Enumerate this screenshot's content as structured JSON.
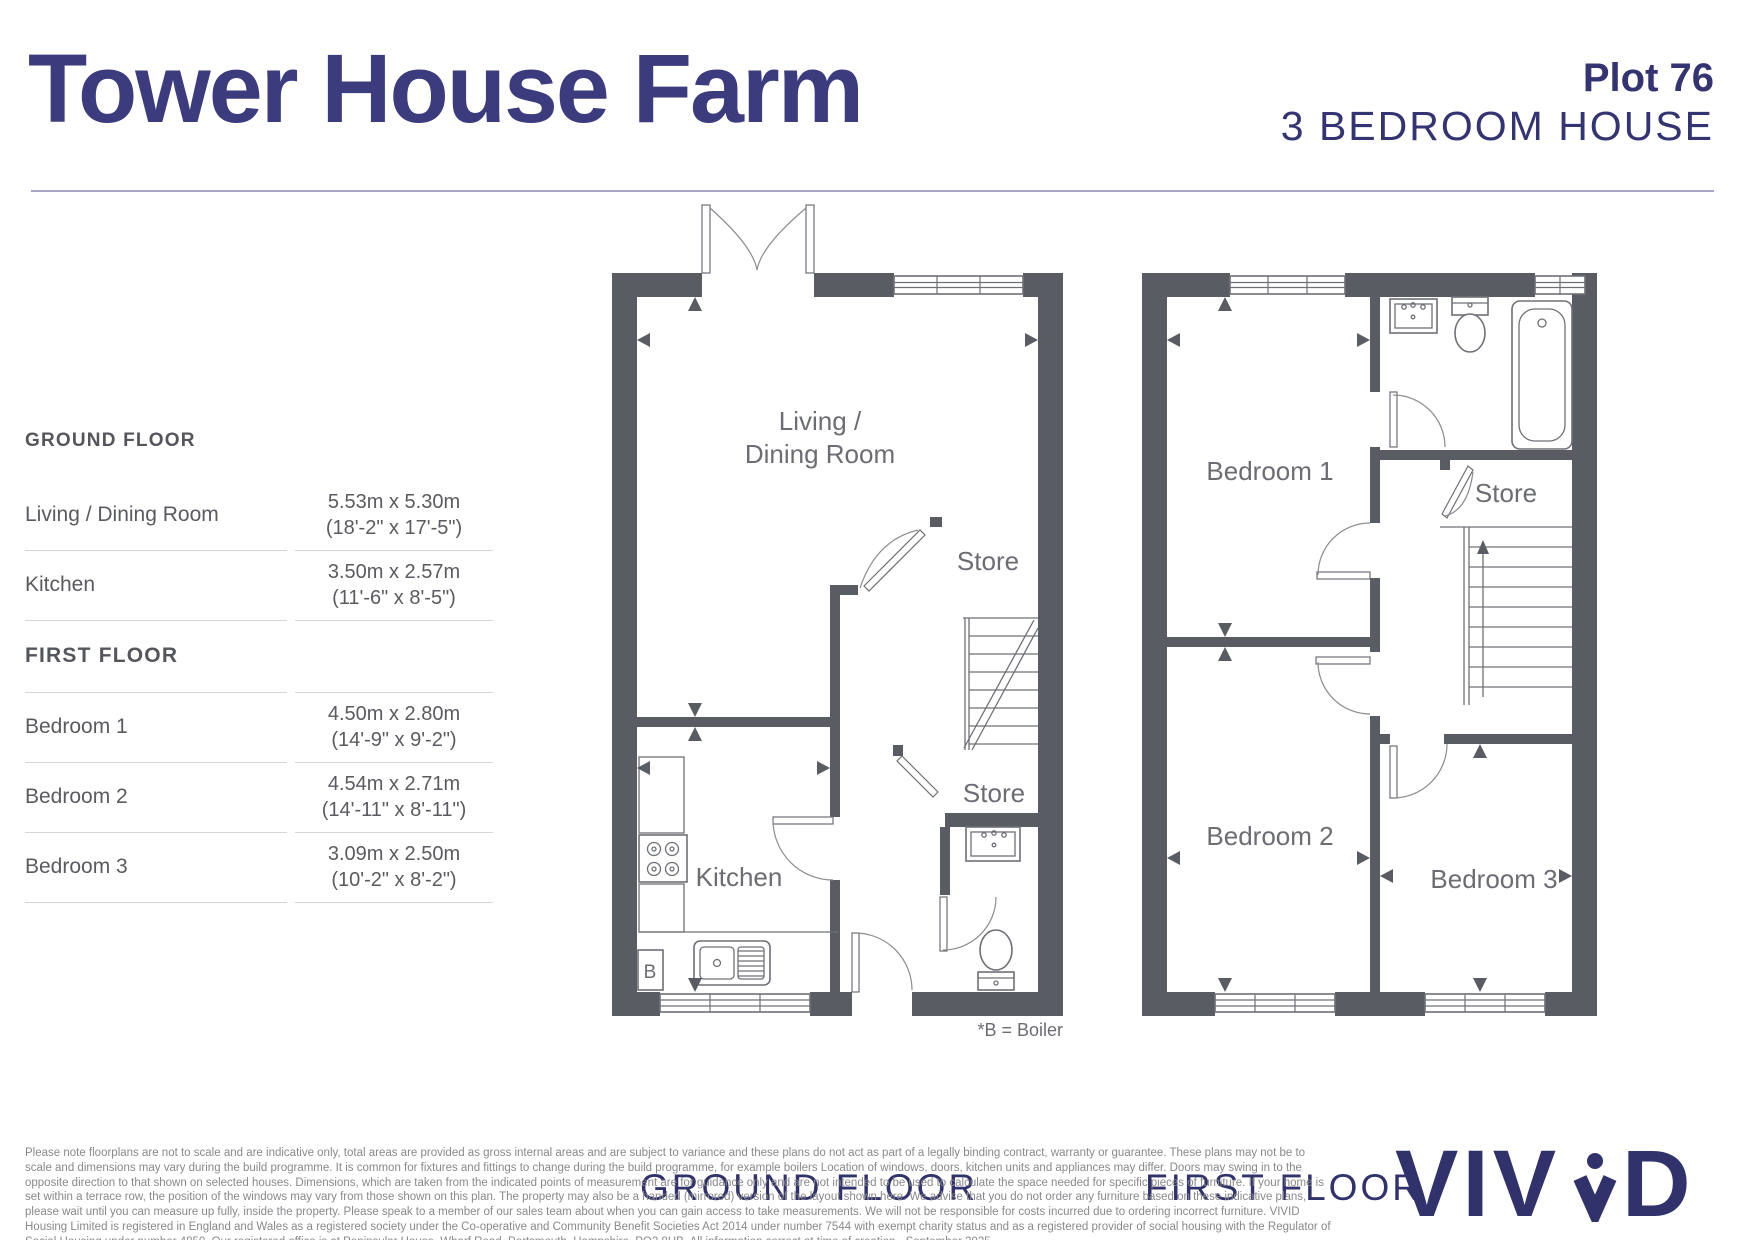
{
  "header": {
    "title": "Tower House Farm",
    "plot": "Plot 76",
    "subtitle": "3 BEDROOM HOUSE"
  },
  "dimensions_table": {
    "sections": [
      {
        "heading": "GROUND FLOOR",
        "rows": [
          {
            "label": "Living / Dining Room",
            "metric": "5.53m x 5.30m",
            "imperial": "(18'-2\" x 17'-5\")"
          },
          {
            "label": "Kitchen",
            "metric": "3.50m x 2.57m",
            "imperial": "(11'-6\" x 8'-5\")"
          }
        ]
      },
      {
        "heading": "FIRST FLOOR",
        "rows": [
          {
            "label": "Bedroom 1",
            "metric": "4.50m x 2.80m",
            "imperial": "(14'-9\" x 9'-2\")"
          },
          {
            "label": "Bedroom 2",
            "metric": "4.54m x 2.71m",
            "imperial": "(14'-11\" x 8'-11\")"
          },
          {
            "label": "Bedroom 3",
            "metric": "3.09m x 2.50m",
            "imperial": "(10'-2\" x 8'-2\")"
          }
        ]
      }
    ]
  },
  "ground_floor": {
    "caption": "GROUND FLOOR",
    "boiler_note": "*B = Boiler",
    "labels": {
      "living_line1": "Living /",
      "living_line2": "Dining Room",
      "kitchen": "Kitchen",
      "store_upper": "Store",
      "store_under_stairs": "Store",
      "boiler_abbrev": "B"
    }
  },
  "first_floor": {
    "caption": "FIRST FLOOR",
    "labels": {
      "bedroom1": "Bedroom 1",
      "bedroom2": "Bedroom 2",
      "bedroom3": "Bedroom 3",
      "store": "Store"
    }
  },
  "footer": {
    "disclaimer": "Please note floorplans are not to scale and are indicative only, total areas are provided as gross internal areas and are subject to variance and these plans do not act as part of a legally binding contract, warranty or guarantee. These plans may not be to scale and dimensions may vary during the build programme. It is common for fixtures and fittings to change during the build programme, for example boilers Location of windows, doors, kitchen units and appliances may differ. Doors may swing in to the opposite direction to that shown on selected houses. Dimensions, which are taken from the indicated points of measurement are for guidance only and are not intended to be used to calculate the space needed for specific pieces of furniture. If your home is set within a terrace row, the position of the windows may vary from those shown on this plan. The property may also be a handed (mirrored) version of the layout shown here. We advise that you do not order any furniture based on these indicative plans, please wait until you can measure up fully, inside the property. Please speak to a member of our sales team about when you can gain access to take measurements. We will not be responsible for costs incurred due to ordering incorrect furniture. VIVID Housing Limited is registered in England and Wales as a registered society under the Co-operative and Community Benefit Societies Act 2014 under number 7544 with exempt charity status and as a registered provider of social housing with the Regulator of Social Housing under number 4850. Our registered office is at Peninsular House, Wharf Road, Portsmouth, Hampshire, PO2 8HB. All information correct at time of creation - September 2025.",
    "logo": {
      "text": "VIVID",
      "part_before_mark": "VIV",
      "part_after_mark": "D"
    }
  },
  "colors": {
    "brand_navy": "#3b3b7e",
    "heading_navy": "#343473",
    "caption_navy": "#31316b",
    "wall_grey": "#5a5c63",
    "room_label_grey": "#6b6d73",
    "table_text_grey": "#595b60",
    "divider_grey": "#d7d7d7",
    "disclaimer_grey": "#88898c"
  }
}
